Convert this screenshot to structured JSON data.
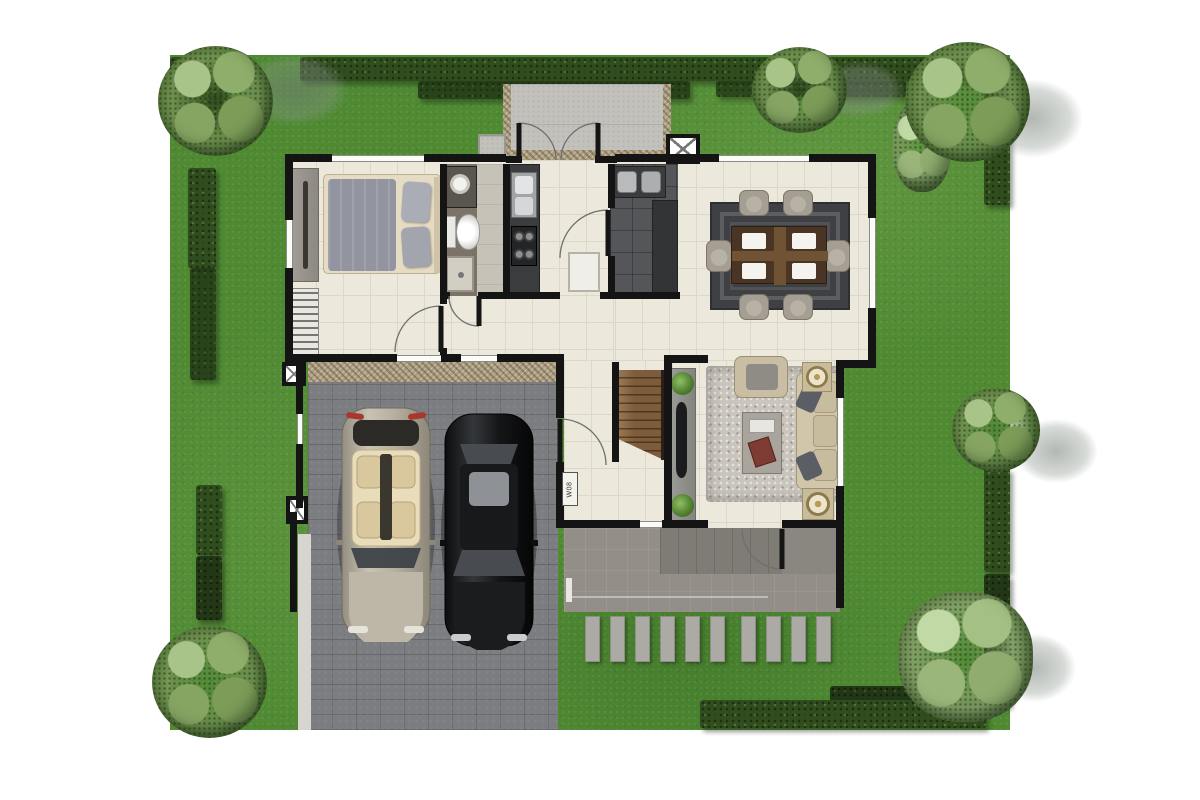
{
  "scene": {
    "description": "Top-down 3D rendered ground-floor plan of a house with green lawn, hedges, trees, two-car garage, bedroom, bathroom, kitchen, utility room, dining set, living room, rear terrace and stepping-stone path",
    "label": {
      "text": "W08"
    },
    "counts": {
      "stepping_stones": 10,
      "dining_chairs": 6,
      "cars": 2,
      "trees": 6,
      "dining_place_settings": 4
    },
    "palette": {
      "background": "#ffffff",
      "grass": "#4f8a33",
      "hedge": "#2f4d1d",
      "floor_tile": "#ece8db",
      "wall": "#141414",
      "garage_paving": "#7b7d81",
      "terrace": "#938f88",
      "service_pad": "#c3c1bb",
      "stair_wood": "#7d5c3b",
      "dining_rug": "#3f4043",
      "living_rug": "#c9c4bc",
      "sofa": "#d2c6aa",
      "car_convertible": "#b6afa0",
      "car_sedan": "#141517",
      "stepping_stone": "#abaaa4",
      "counter_dark": "#3b3c3e",
      "bathroom_floor": "#7b7268",
      "utility_floor": "#55565a"
    }
  }
}
